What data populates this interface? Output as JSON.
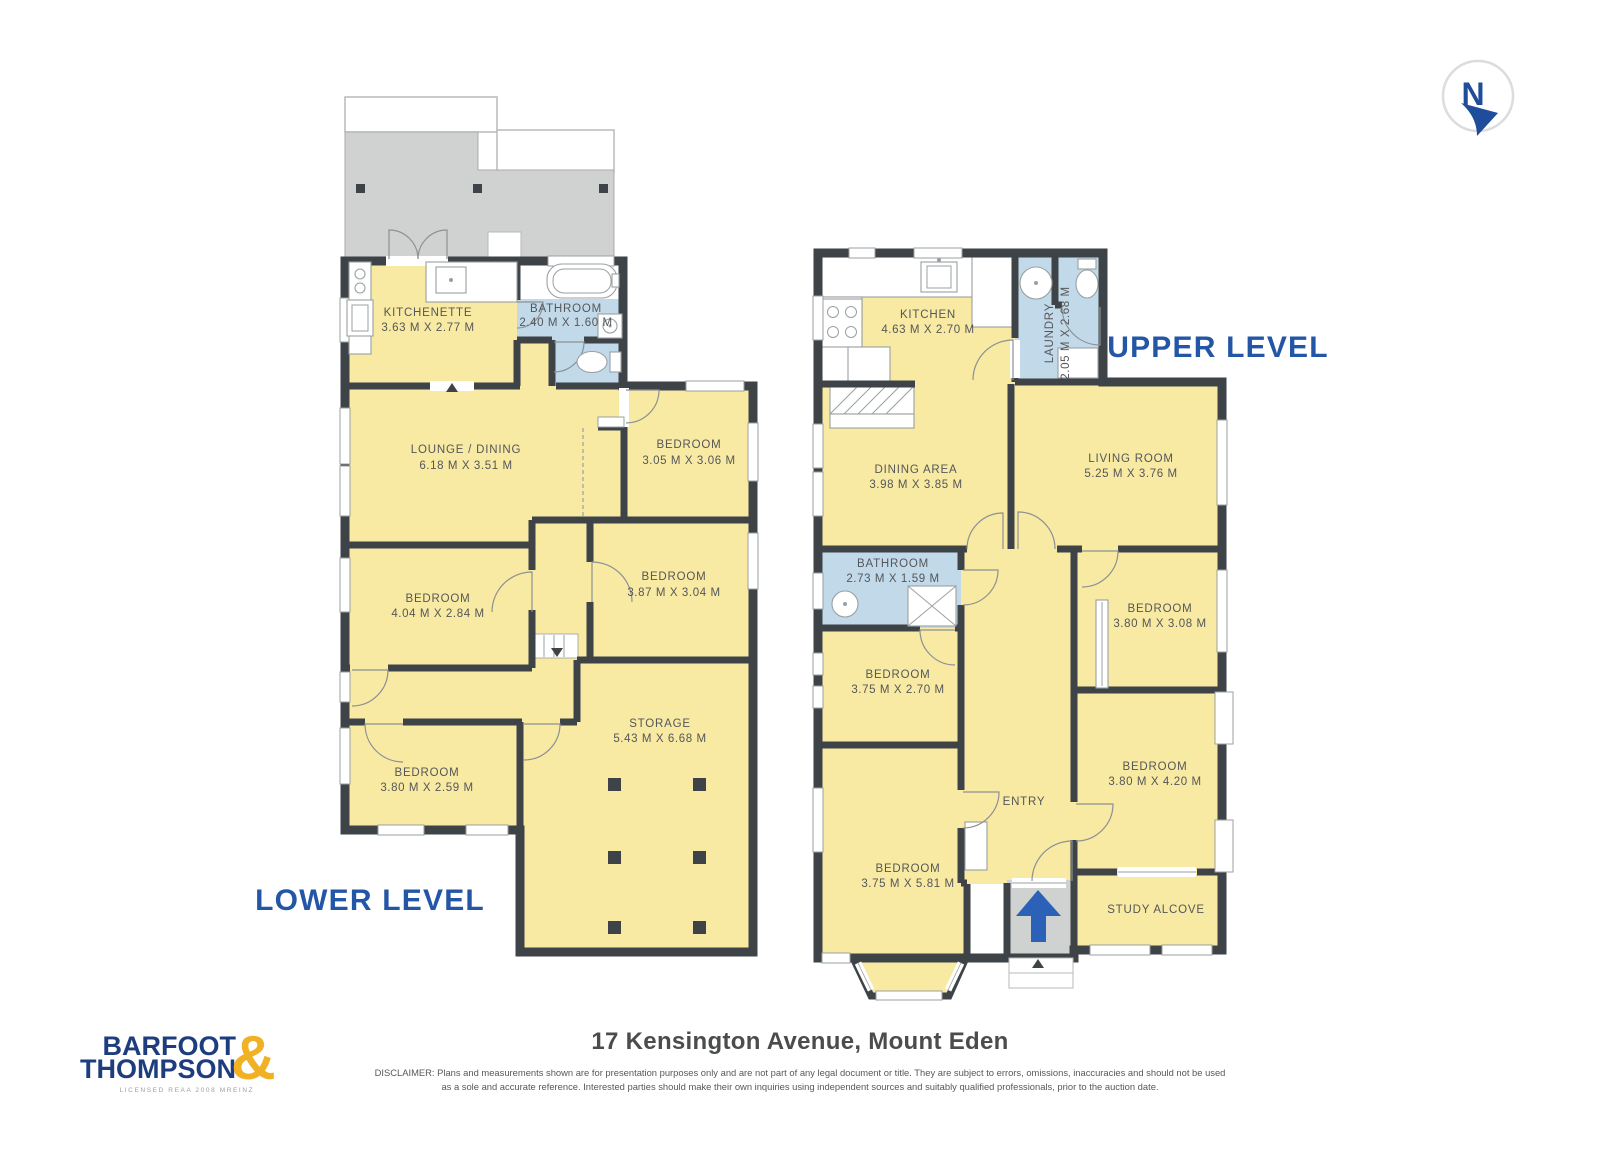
{
  "compass": {
    "letter": "N"
  },
  "levels": {
    "lower": {
      "label": "LOWER LEVEL",
      "rooms": {
        "kitchenette": {
          "name": "KITCHENETTE",
          "dims": "3.63 M X 2.77 M"
        },
        "bathroom": {
          "name": "BATHROOM",
          "dims": "2.40 M X 1.60 M"
        },
        "lounge_dining": {
          "name": "LOUNGE / DINING",
          "dims": "6.18 M X 3.51 M"
        },
        "bedroom_a": {
          "name": "BEDROOM",
          "dims": "3.05 M X 3.06 M"
        },
        "bedroom_b": {
          "name": "BEDROOM",
          "dims": "4.04 M X 2.84 M"
        },
        "bedroom_c": {
          "name": "BEDROOM",
          "dims": "3.87 M X 3.04 M"
        },
        "bedroom_d": {
          "name": "BEDROOM",
          "dims": "3.80 M X 2.59 M"
        },
        "storage": {
          "name": "STORAGE",
          "dims": "5.43 M X 6.68 M"
        }
      }
    },
    "upper": {
      "label": "UPPER LEVEL",
      "rooms": {
        "kitchen": {
          "name": "KITCHEN",
          "dims": "4.63 M X 2.70 M"
        },
        "laundry": {
          "name": "LAUNDRY",
          "dims": "2.05 M X 2.68 M"
        },
        "dining_area": {
          "name": "DINING AREA",
          "dims": "3.98 M X 3.85 M"
        },
        "living_room": {
          "name": "LIVING ROOM",
          "dims": "5.25 M X 3.76 M"
        },
        "bathroom": {
          "name": "BATHROOM",
          "dims": "2.73 M X 1.59 M"
        },
        "bedroom_a": {
          "name": "BEDROOM",
          "dims": "3.80 M X 3.08 M"
        },
        "bedroom_b": {
          "name": "BEDROOM",
          "dims": "3.75 M X 2.70 M"
        },
        "bedroom_c": {
          "name": "BEDROOM",
          "dims": "3.80 M X 4.20 M"
        },
        "bedroom_d": {
          "name": "BEDROOM",
          "dims": "3.75 M X 5.81 M"
        },
        "entry": {
          "name": "ENTRY"
        },
        "study_alcove": {
          "name": "STUDY ALCOVE"
        }
      }
    }
  },
  "footer": {
    "brand_line1": "BARFOOT",
    "brand_line2": "THOMPSON",
    "brand_amp": "&",
    "brand_tagline": "LICENSED REAA 2008 MREINZ",
    "address": "17 Kensington Avenue, Mount Eden",
    "disclaimer_line1": "DISCLAIMER: Plans and measurements shown are for presentation purposes only and are not part of any legal document or title. They are subject to errors, omissions, inaccuracies and should not be used",
    "disclaimer_line2": "as a sole and accurate reference. Interested parties should make their own inquiries using independent sources and suitably qualified professionals, prior to the auction date."
  },
  "colors": {
    "room_fill": "#F8E9A3",
    "wet_room_fill": "#C2D9E9",
    "wall": "#3E4347",
    "deck_fill": "#D0D2D1",
    "accent_blue": "#2356A6",
    "logo_navy": "#1E3D7E",
    "logo_gold": "#F0B125",
    "entry_arrow_blue": "#2B62B8"
  }
}
